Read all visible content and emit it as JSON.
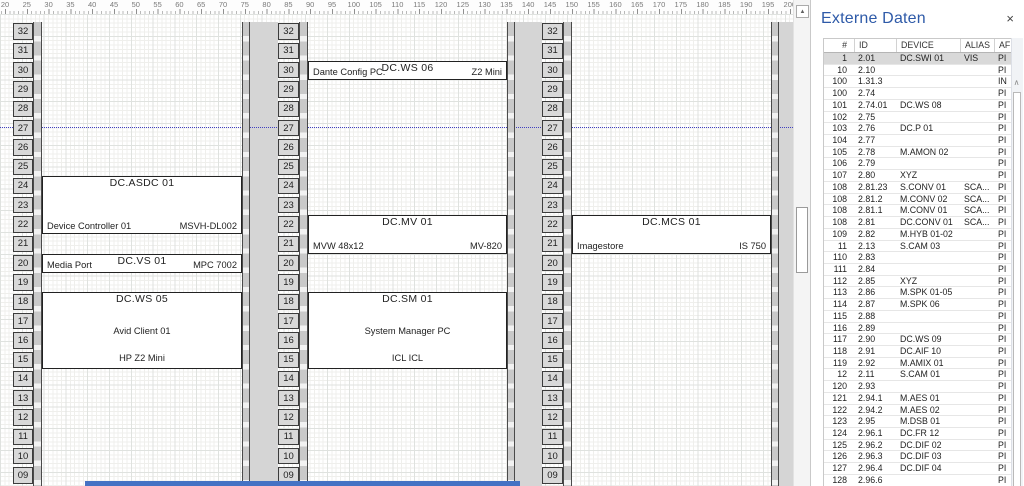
{
  "colors": {
    "accent_blue": "#2e5aa8",
    "selected_row_bg": "#d9d9d9",
    "page_break_line": "#4040c0",
    "bottom_bar": "#4472c4",
    "rack_fill": "#d9d9d9"
  },
  "icons": {
    "close": "×",
    "scroll_up": "▲",
    "table_scroll_up": "∧"
  },
  "ruler": {
    "min": 20,
    "max": 200,
    "step": 5
  },
  "drawing": {
    "rack_units": {
      "top": 32,
      "bottom": 9
    },
    "racks": [
      {
        "blocks": [
          {
            "unit_top": 24,
            "units": 3,
            "title": "DC.ASDC 01",
            "bottom_left": "Device Controller 01",
            "bottom_right": "MSVH-DL002"
          },
          {
            "unit_top": 20,
            "units": 1,
            "title": "DC.VS 01",
            "bottom_left": "Media Port",
            "bottom_right": "MPC 7002"
          },
          {
            "unit_top": 18,
            "units": 4,
            "title": "DC.WS 05",
            "middle": "Avid Client 01",
            "bottom_center": "HP Z2 Mini"
          }
        ]
      },
      {
        "blocks": [
          {
            "unit_top": 30,
            "units": 1,
            "title": "DC.WS 06",
            "bottom_left": "Dante Config PC.",
            "bottom_right": "Z2 Mini"
          },
          {
            "unit_top": 22,
            "units": 2,
            "title": "DC.MV 01",
            "bottom_left": "MVW 48x12",
            "bottom_right": "MV-820"
          },
          {
            "unit_top": 18,
            "units": 4,
            "title": "DC.SM 01",
            "middle": "System Manager PC",
            "bottom_center": "ICL ICL"
          }
        ]
      },
      {
        "blocks": [
          {
            "unit_top": 22,
            "units": 2,
            "title": "DC.MCS 01",
            "bottom_left": "Imagestore",
            "bottom_right": "IS 750"
          }
        ]
      }
    ]
  },
  "panel": {
    "title": "Externe Daten",
    "table": {
      "headers": [
        "#",
        "ID",
        "DEVICE",
        "ALIAS",
        "AF"
      ],
      "selected_row": 0,
      "rows": [
        [
          "1",
          "2.01",
          "DC.SWI 01",
          "VIS",
          "PI"
        ],
        [
          "10",
          "2.10",
          "",
          "",
          "PI"
        ],
        [
          "100",
          "1.31.3",
          "",
          "",
          "IN"
        ],
        [
          "100",
          "2.74",
          "",
          "",
          "PI"
        ],
        [
          "101",
          "2.74.01",
          "DC.WS 08",
          "",
          "PI"
        ],
        [
          "102",
          "2.75",
          "",
          "",
          "PI"
        ],
        [
          "103",
          "2.76",
          "DC.P 01",
          "",
          "PI"
        ],
        [
          "104",
          "2.77",
          "",
          "",
          "PI"
        ],
        [
          "105",
          "2.78",
          "M.AMON 02",
          "",
          "PI"
        ],
        [
          "106",
          "2.79",
          "",
          "",
          "PI"
        ],
        [
          "107",
          "2.80",
          "XYZ",
          "",
          "PI"
        ],
        [
          "108",
          "2.81.23",
          "S.CONV 01",
          "SCA...",
          "PI"
        ],
        [
          "108",
          "2.81.2",
          "M.CONV 02",
          "SCA...",
          "PI"
        ],
        [
          "108",
          "2.81.1",
          "M.CONV 01",
          "SCA...",
          "PI"
        ],
        [
          "108",
          "2.81",
          "DC.CONV 01",
          "SCA...",
          "PI"
        ],
        [
          "109",
          "2.82",
          "M.HYB 01-02",
          "",
          "PI"
        ],
        [
          "11",
          "2.13",
          "S.CAM 03",
          "",
          "PI"
        ],
        [
          "110",
          "2.83",
          "",
          "",
          "PI"
        ],
        [
          "111",
          "2.84",
          "",
          "",
          "PI"
        ],
        [
          "112",
          "2.85",
          "XYZ",
          "",
          "PI"
        ],
        [
          "113",
          "2.86",
          "M.SPK 01-05",
          "",
          "PI"
        ],
        [
          "114",
          "2.87",
          "M.SPK 06",
          "",
          "PI"
        ],
        [
          "115",
          "2.88",
          "",
          "",
          "PI"
        ],
        [
          "116",
          "2.89",
          "",
          "",
          "PI"
        ],
        [
          "117",
          "2.90",
          "DC.WS 09",
          "",
          "PI"
        ],
        [
          "118",
          "2.91",
          "DC.AIF 10",
          "",
          "PI"
        ],
        [
          "119",
          "2.92",
          "M.AMIX 01",
          "",
          "PI"
        ],
        [
          "12",
          "2.11",
          "S.CAM 01",
          "",
          "PI"
        ],
        [
          "120",
          "2.93",
          "",
          "",
          "PI"
        ],
        [
          "121",
          "2.94.1",
          "M.AES 01",
          "",
          "PI"
        ],
        [
          "122",
          "2.94.2",
          "M.AES 02",
          "",
          "PI"
        ],
        [
          "123",
          "2.95",
          "M.DSB 01",
          "",
          "PI"
        ],
        [
          "124",
          "2.96.1",
          "DC.FR 12",
          "",
          "PI"
        ],
        [
          "125",
          "2.96.2",
          "DC.DIF 02",
          "",
          "PI"
        ],
        [
          "126",
          "2.96.3",
          "DC.DIF 03",
          "",
          "PI"
        ],
        [
          "127",
          "2.96.4",
          "DC.DIF 04",
          "",
          "PI"
        ],
        [
          "128",
          "2.96.6",
          "",
          "",
          "PI"
        ]
      ]
    }
  }
}
